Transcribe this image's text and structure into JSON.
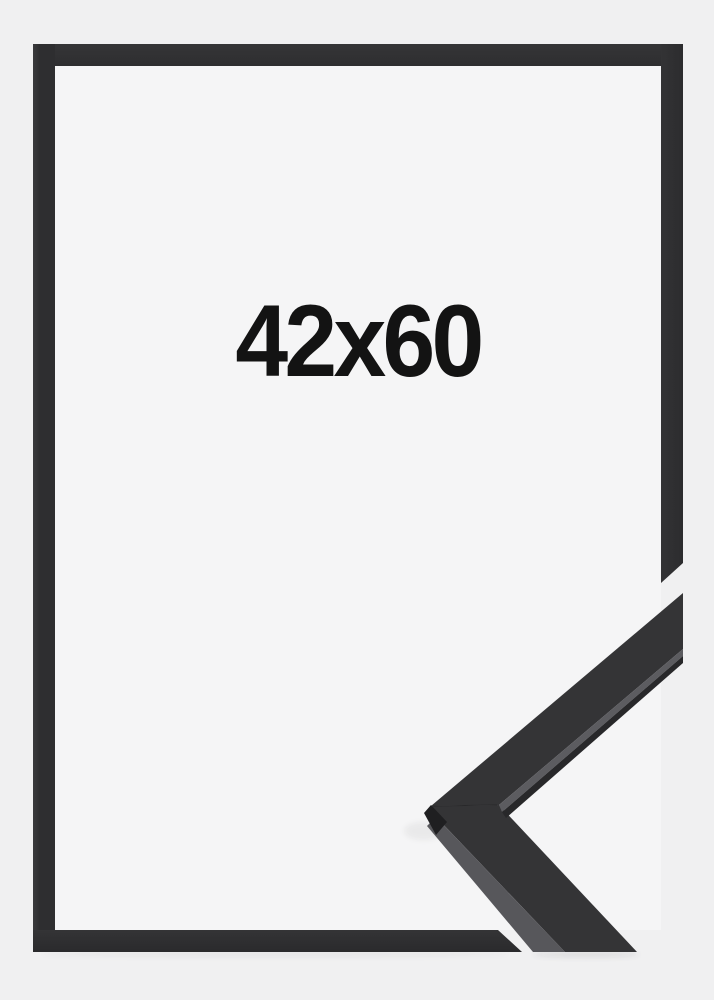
{
  "product_image": {
    "size_label": "42x60",
    "subject": "black-picture-frame-corner-sample"
  },
  "colors": {
    "outer_background": "#f0f0f1",
    "inner_background": "#f5f5f6",
    "frame_bar": "#2f2f31",
    "corner_top_face": "#343436",
    "corner_side_face": "#57575b",
    "corner_light_edge": "#5c5c60",
    "corner_under_edge": "#28282a",
    "corner_bottom_face": "#1f1f21",
    "text": "#131313"
  }
}
